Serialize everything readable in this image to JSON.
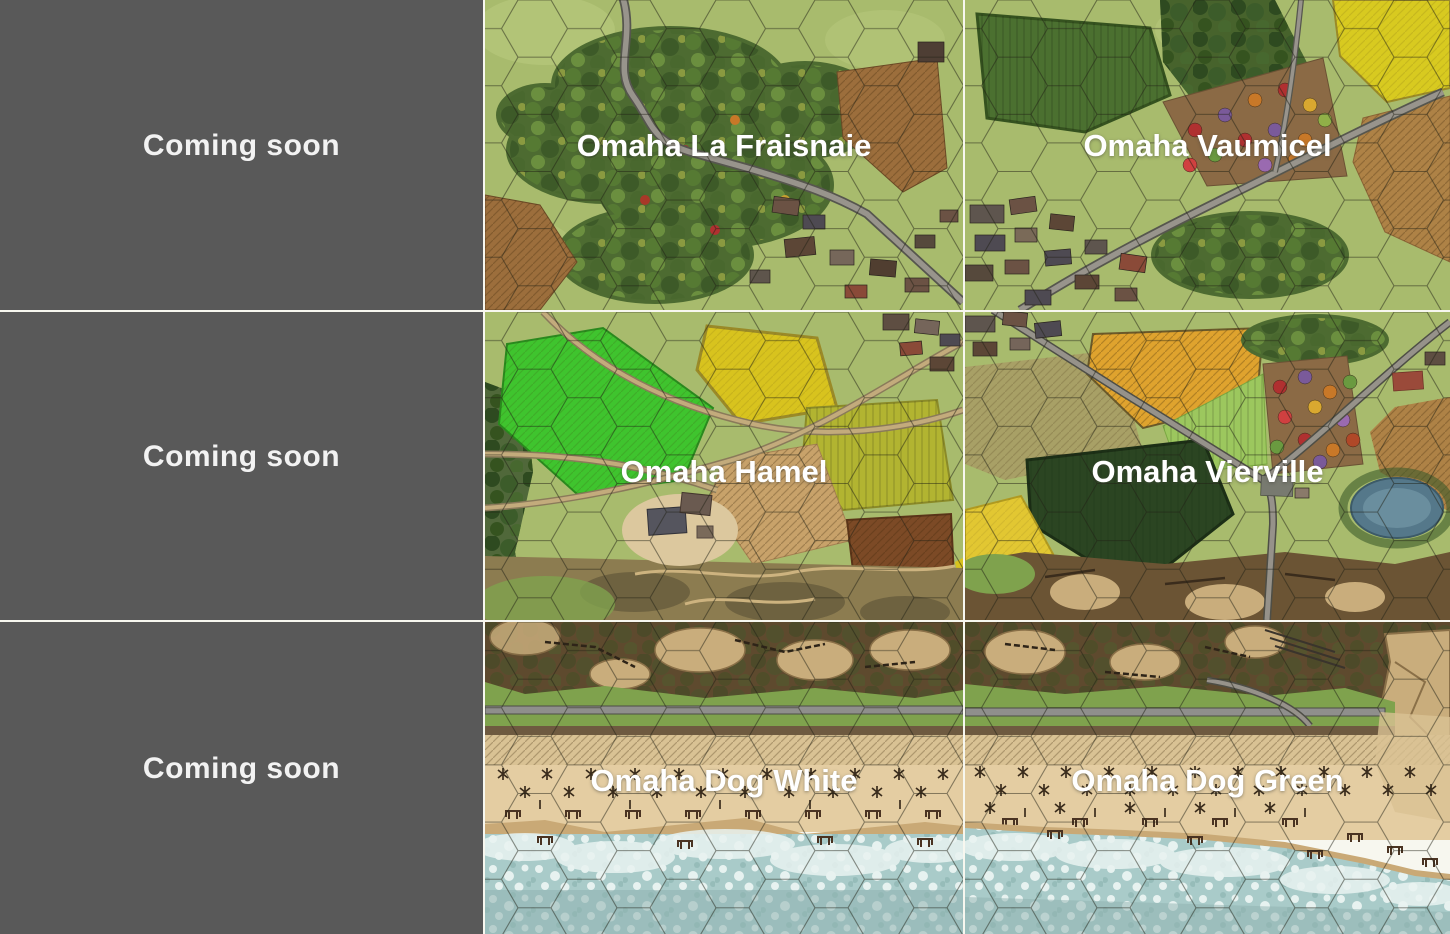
{
  "gallery": {
    "placeholder": {
      "label": "Coming soon"
    },
    "maps": {
      "la_fraisnaie": {
        "label": "Omaha La Fraisnaie"
      },
      "vaumicel": {
        "label": "Omaha Vaumicel"
      },
      "hamel": {
        "label": "Omaha Hamel"
      },
      "vierville": {
        "label": "Omaha Vierville"
      },
      "dog_white": {
        "label": "Omaha Dog White"
      },
      "dog_green": {
        "label": "Omaha Dog Green"
      }
    }
  },
  "colors": {
    "placeholder_bg": "#595959",
    "divider": "#f7f7ef",
    "label_text": "#ffffff",
    "meadow": "#a8bb6d",
    "forest": "#4d6b31",
    "plowed_field": "#9c6e3c",
    "yellow_field": "#d8ca20",
    "bright_green_field": "#3fc42e",
    "beach_sand": "#e4cda2",
    "bluff_brown": "#5e4a2e",
    "water": "#a9cbc9"
  }
}
